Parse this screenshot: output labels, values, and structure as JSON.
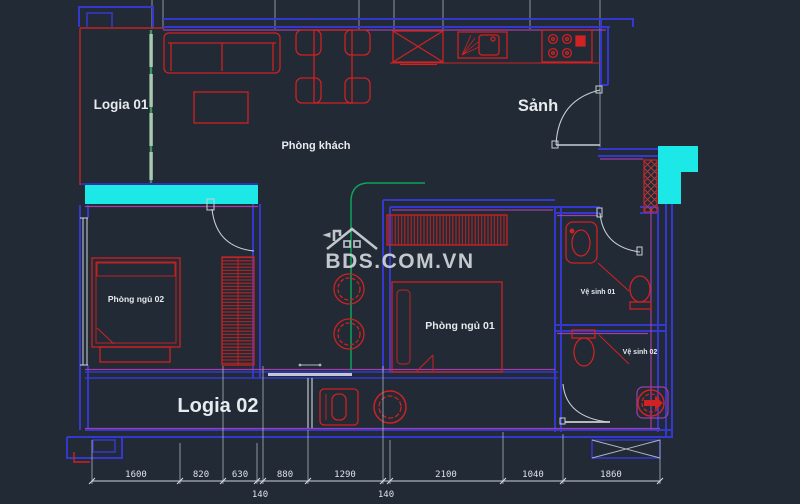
{
  "rooms": {
    "logia01": "Logia 01",
    "living": "Phòng khách",
    "hall": "Sảnh",
    "bedroom02": "Phòng ngủ 02",
    "bedroom01": "Phòng ngủ 01",
    "bath01": "Vệ sinh 01",
    "bath02": "Vệ sinh 02",
    "logia02": "Logia 02"
  },
  "watermark": {
    "text": "BDS.COM.VN",
    "logo": "house-icon"
  },
  "dimensions": {
    "bottom": [
      "1600",
      "820",
      "630",
      "880",
      "1290",
      "2100",
      "1040",
      "1860"
    ],
    "wall_thickness": [
      "140",
      "140"
    ]
  },
  "colors": {
    "background": "#212a35",
    "wall_blue": "#3438cf",
    "furniture_red": "#cf2222",
    "highlight_cyan": "#1ce8e8",
    "door_green": "#2e9e62",
    "accent_magenta": "#a03fa8",
    "line_gray": "#cfd4da",
    "text_white": "#e8ebee"
  }
}
